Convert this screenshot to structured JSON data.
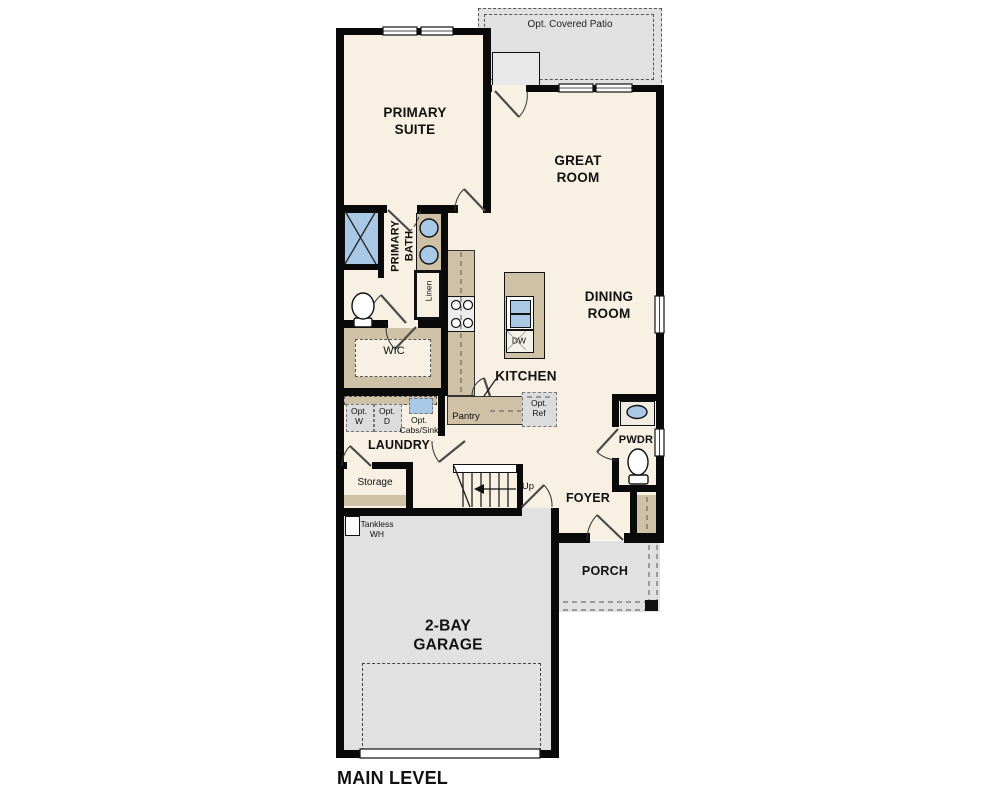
{
  "title": "MAIN LEVEL",
  "colors": {
    "floor": "#f7f0e3",
    "outdoor": "#e1e1e1",
    "casework": "#cfc1a6",
    "fixture_blue": "#a9c8e6",
    "wall": "#0a0a0a"
  },
  "labels": {
    "opt_covered_patio": "Opt. Covered Patio",
    "primary_suite": "PRIMARY\nSUITE",
    "great_room": "GREAT\nROOM",
    "dining_room": "DINING\nROOM",
    "primary_bath": "PRIMARY\nBATH",
    "linen": "Linen",
    "wic": "WIC",
    "kitchen": "KITCHEN",
    "pantry": "Pantry",
    "dw": "DW",
    "opt_ref": "Opt.\nRef",
    "opt_w": "Opt.\nW",
    "opt_d": "Opt.\nD",
    "opt_cabs_sink": "Opt.\nCabs/Sink",
    "laundry": "LAUNDRY",
    "storage": "Storage",
    "up": "Up",
    "tankless_wh": "Tankless\nWH",
    "pwdr": "PWDR",
    "foyer": "FOYER",
    "porch": "PORCH",
    "garage": "2-BAY\nGARAGE",
    "main_level": "MAIN LEVEL"
  }
}
